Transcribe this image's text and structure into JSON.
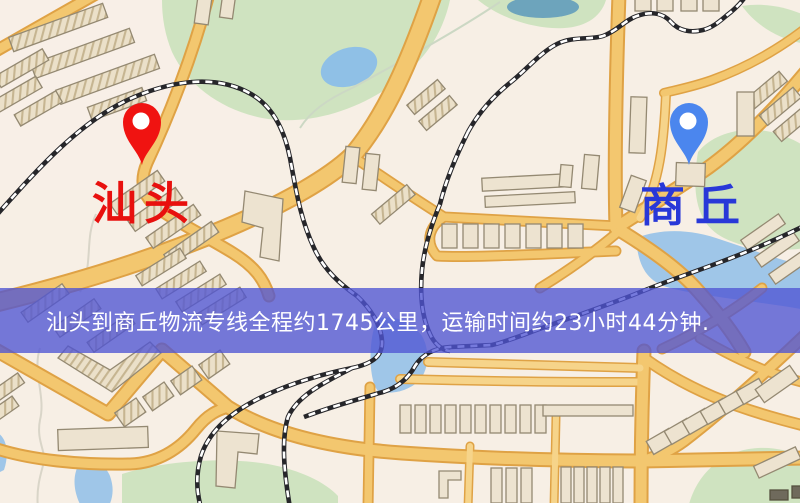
{
  "banner": {
    "text": "汕头到商丘物流专线全程约1745公里，运输时间约23小时44分钟.",
    "bg_color": "rgba(80,84,212,0.78)",
    "text_color": "#ffffff"
  },
  "route": {
    "origin": "汕头",
    "destination": "商丘",
    "distance_km": 1745,
    "duration_hours": 23,
    "duration_minutes": 44
  },
  "markers": {
    "origin": {
      "label": "汕头",
      "label_color": "#e8100e",
      "pin_color": "#f01311",
      "pin_hole_color": "#ffffff"
    },
    "destination": {
      "label": "商丘",
      "label_color": "#2838d8",
      "pin_color": "#4b86ee",
      "pin_hole_color": "#ffffff"
    }
  },
  "map_colors": {
    "background": "#f7efe5",
    "road_fill": "#f3c76f",
    "road_casing": "#dfa245",
    "park": "#cfe3c0",
    "water": "#9fc6e8",
    "railway": "#26262a",
    "building": "#ebe0c9"
  }
}
